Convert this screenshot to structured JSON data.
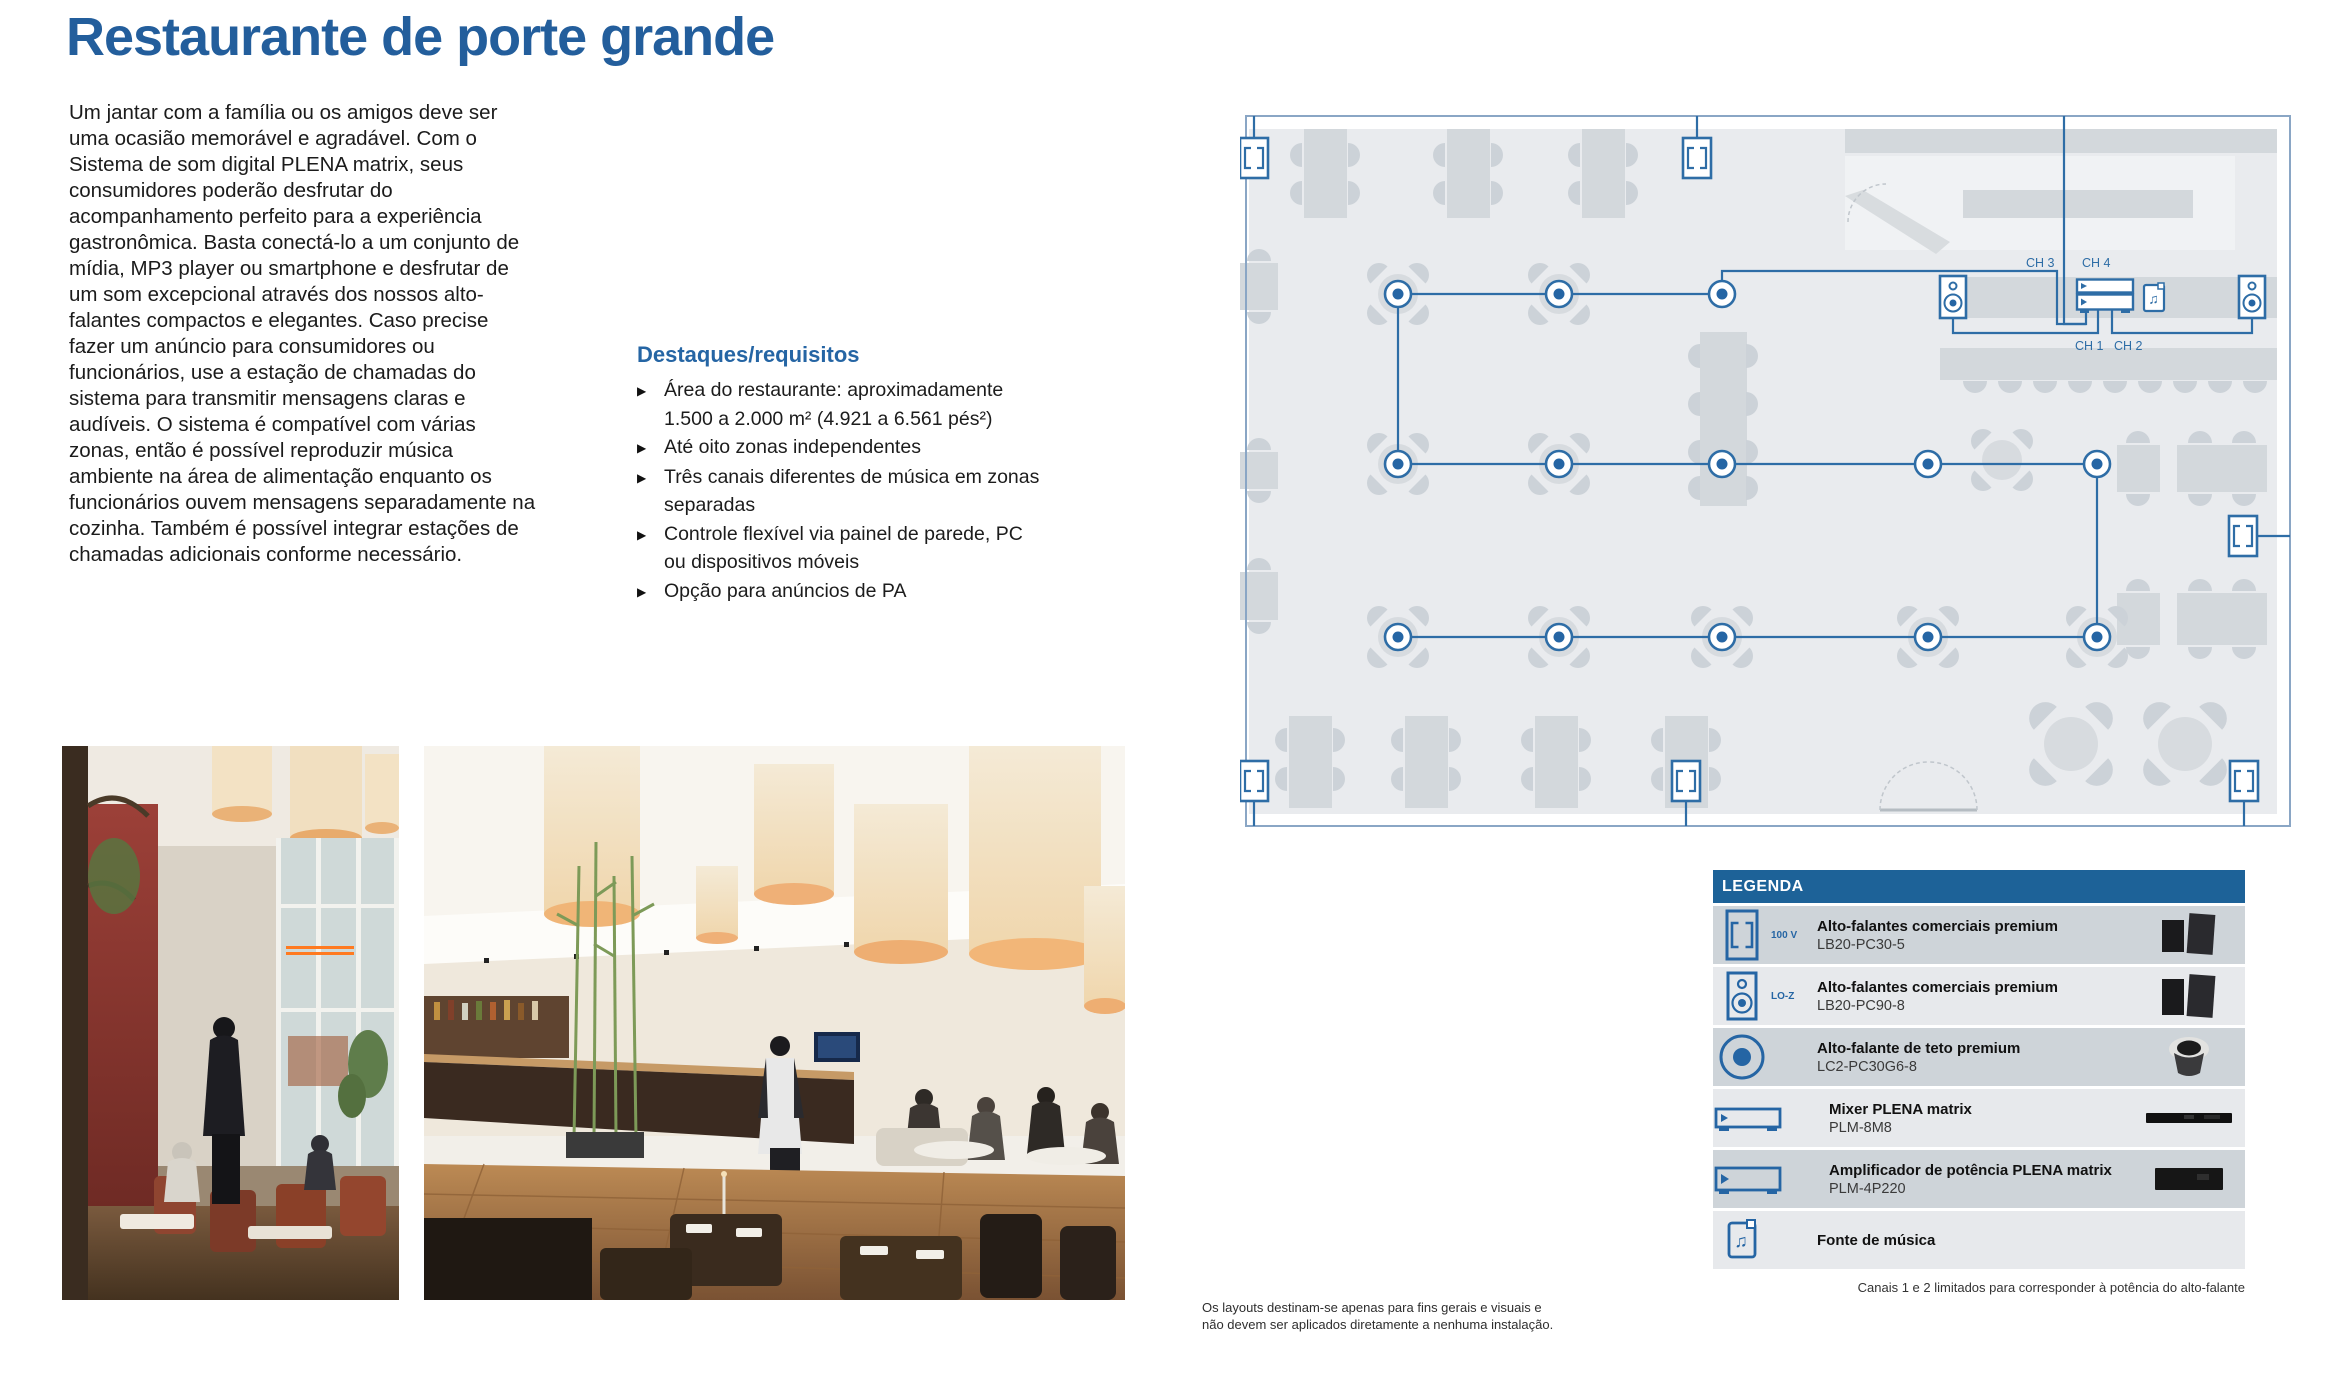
{
  "page": {
    "title": "Restaurante de porte grande",
    "intro": "Um jantar com a família ou os amigos deve ser uma ocasião memorável e agradável. Com o Sistema de som digital PLENA matrix, seus consumidores poderão desfrutar do acompanhamento perfeito para a experiência gastronômica. Basta conectá-lo a um conjunto de mídia, MP3 player ou smartphone e desfrutar de um som excepcional através dos nossos alto-falantes compactos e elegantes. Caso precise fazer um anúncio para consumidores ou funcionários, use a estação de chamadas do sistema para transmitir mensagens claras e audíveis. O sistema é compatível com várias zonas, então é possível reproduzir música ambiente na área de alimentação enquanto os funcionários ouvem mensagens separadamente na cozinha. Também é possível integrar estações de chamadas adicionais conforme necessário.",
    "highlights": {
      "heading": "Destaques/requisitos",
      "items": [
        "Área do restaurante: aproximadamente 1.500 a 2.000 m² (4.921 a 6.561 pés²)",
        "Até oito zonas independentes",
        "Três canais diferentes de música em zonas separadas",
        "Controle flexível via painel de parede, PC ou dispositivos móveis",
        "Opção para anúncios de PA"
      ]
    }
  },
  "diagram": {
    "channel_labels": {
      "ch1": "CH 1",
      "ch2": "CH 2",
      "ch3": "CH 3",
      "ch4": "CH 4"
    }
  },
  "legend": {
    "header": "LEGENDA",
    "rows": [
      {
        "icon": "wall-speaker-100v-icon",
        "icon_label": "100 V",
        "title": "Alto-falantes comerciais premium",
        "model": "LB20-PC30-5"
      },
      {
        "icon": "box-speaker-loz-icon",
        "icon_label": "LO-Z",
        "title": "Alto-falantes comerciais premium",
        "model": "LB20-PC90-8"
      },
      {
        "icon": "ceiling-speaker-icon",
        "icon_label": "",
        "title": "Alto-falante de teto premium",
        "model": "LC2-PC30G6-8"
      },
      {
        "icon": "mixer-icon",
        "icon_label": "",
        "title": "Mixer PLENA matrix",
        "model": "PLM-8M8"
      },
      {
        "icon": "amplifier-icon",
        "icon_label": "",
        "title": "Amplificador de potência PLENA matrix",
        "model": "PLM-4P220"
      },
      {
        "icon": "music-source-icon",
        "icon_label": "",
        "title": "Fonte de música",
        "model": ""
      }
    ],
    "footnote": "Canais 1 e 2 limitados para corresponder à potência do alto-falante"
  },
  "footnotes": {
    "layout_disclaimer": "Os layouts destinam-se apenas para fins gerais e visuais e não devem ser aplicados diretamente a nenhuma instalação."
  },
  "colors": {
    "heading_blue": "#235e9c",
    "accent_blue": "#2565a4",
    "diagram_blue": "#2e6da6",
    "outer_loop_blue": "#8aa6c5",
    "legend_header_blue": "#1d6298",
    "floor_gray": "#e9ebee",
    "furniture_gray": "#d3d8dc"
  }
}
